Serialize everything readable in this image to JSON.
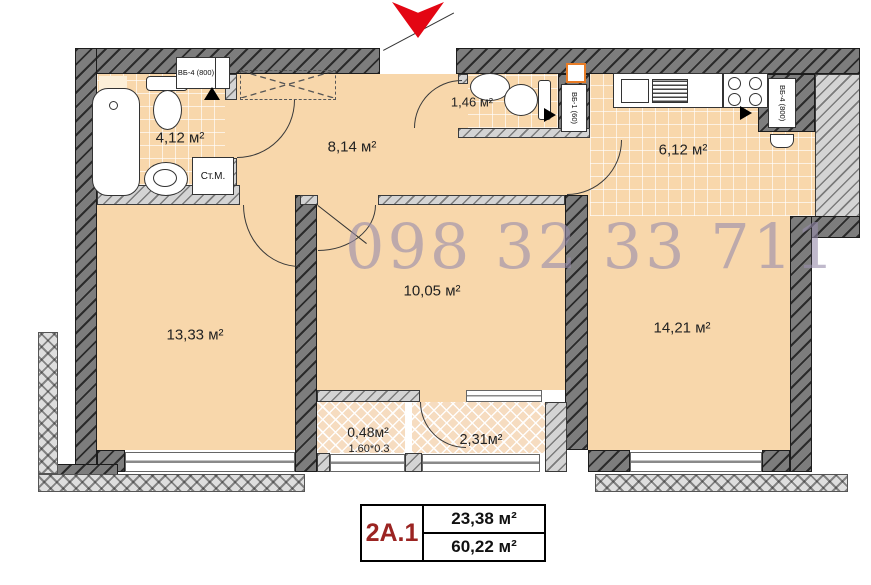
{
  "watermark": "098 32 33 711",
  "rooms": {
    "bathroom": {
      "area": "4,12 м²"
    },
    "hallway": {
      "area": "8,14 м²"
    },
    "wc": {
      "area": "1,46 м²"
    },
    "kitchen": {
      "area": "6,12 м²"
    },
    "living_left": {
      "area": "13,33 м²"
    },
    "living_middle": {
      "area": "10,05 м²"
    },
    "living_right": {
      "area": "14,21 м²"
    },
    "balcony_small": {
      "area": "0,48м²",
      "dims": "1.60*0.3"
    },
    "balcony_large": {
      "area": "2,31м²"
    }
  },
  "fixtures": {
    "washing_machine_label": "Ст.М.",
    "vent_block_bathroom": "ВБ-4 (800)",
    "vent_block_wc": "ВБ-1 (60)",
    "vent_block_kitchen": "ВБ-4 (800)"
  },
  "info_table": {
    "unit_label": "2А.1",
    "area_top": "23,38 м²",
    "area_bottom": "60,22 м²"
  },
  "colors": {
    "floor": "#f8d7ab",
    "entrance_arrow_red": "#e30613",
    "unit_label_red": "#9b2422",
    "watermark_gray": "#978cab"
  }
}
